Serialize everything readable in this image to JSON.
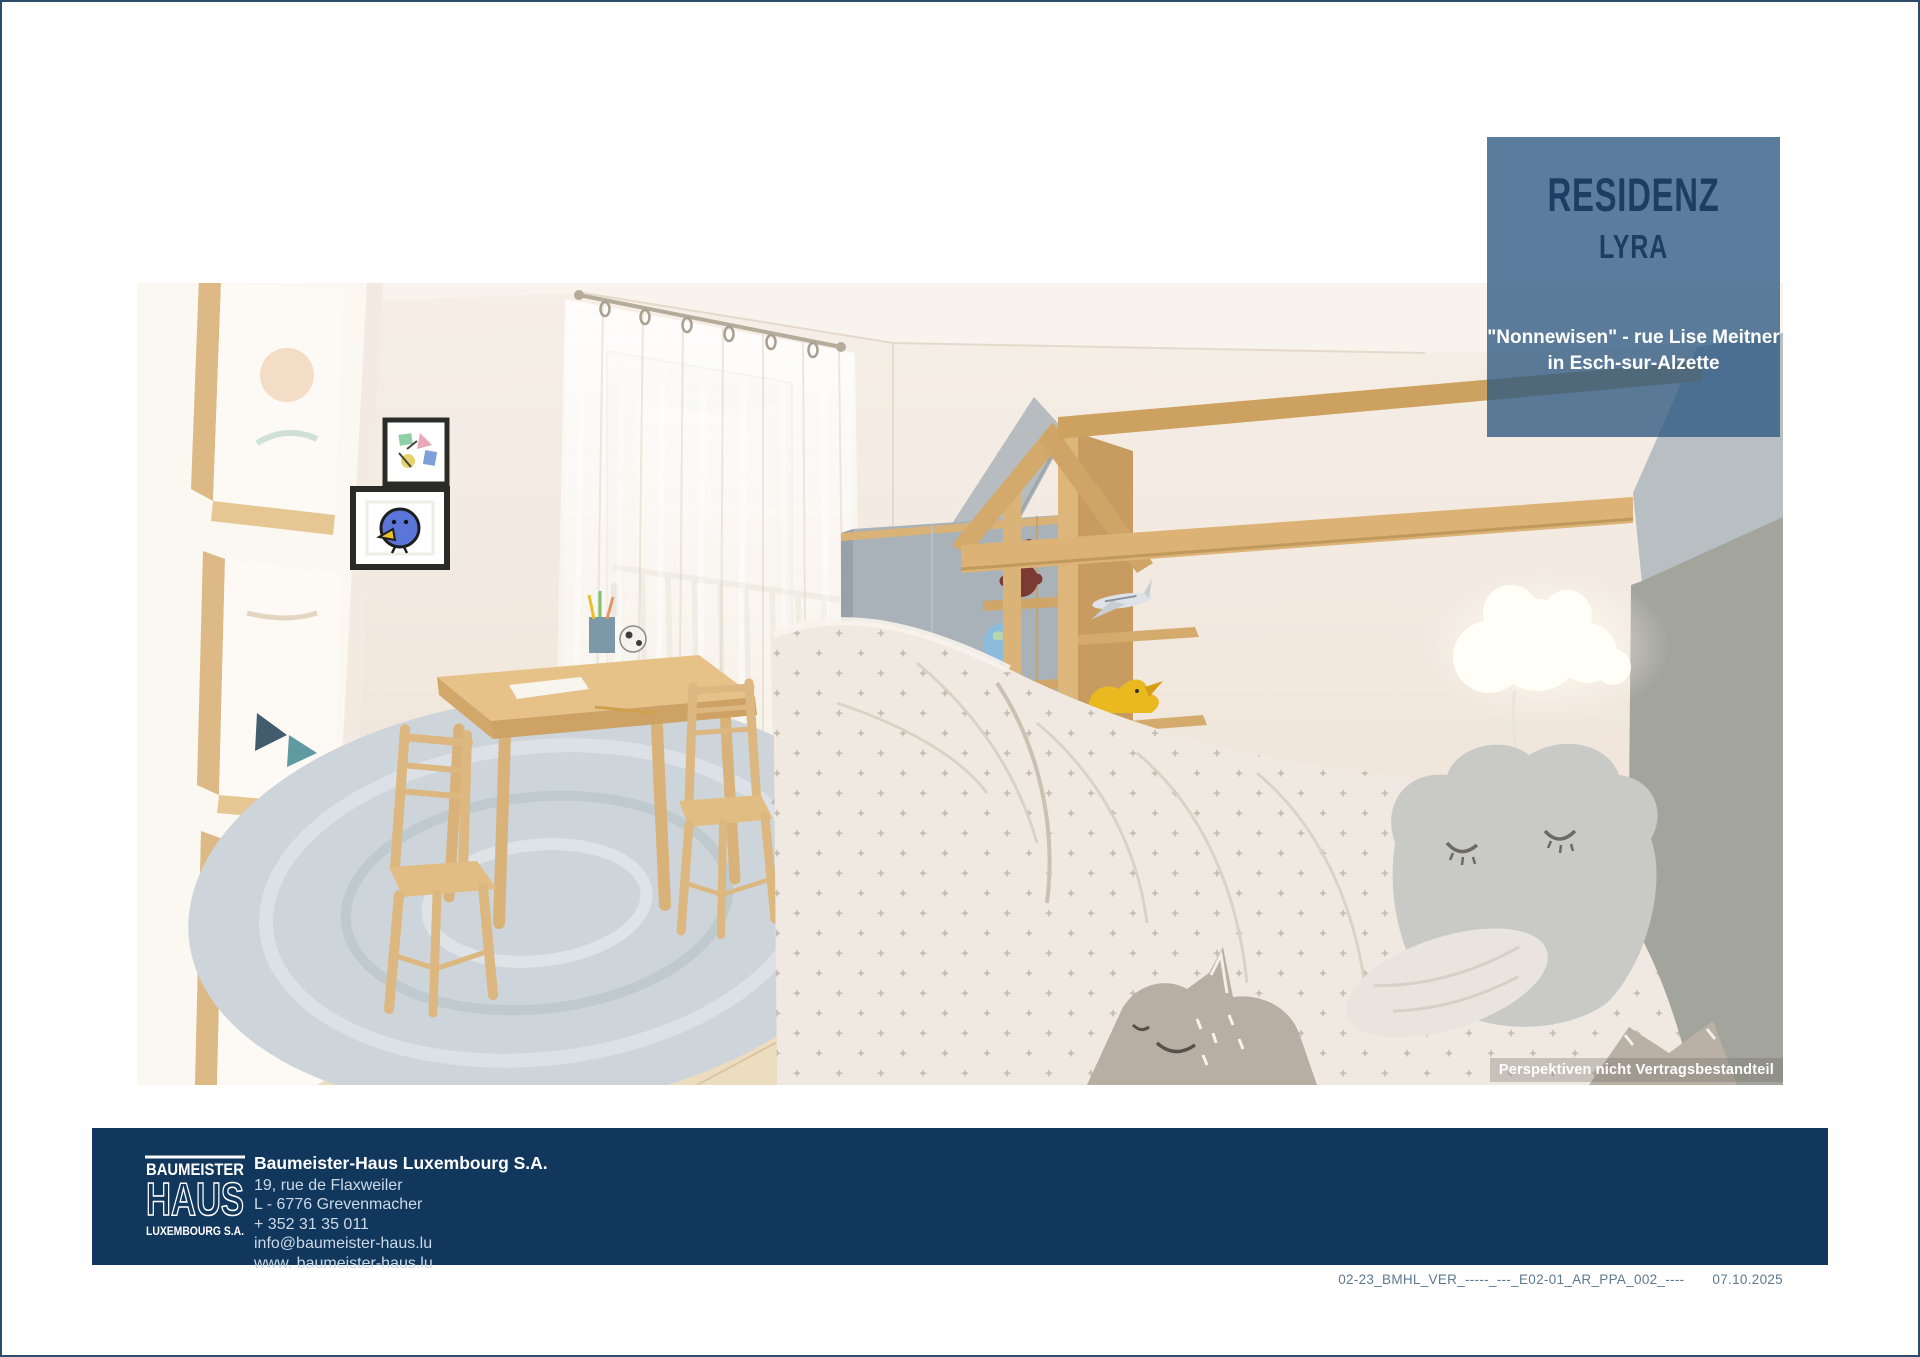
{
  "badge": {
    "title": "RESIDENZ",
    "subtitle": "LYRA",
    "location_line1": "\"Nonnewisen\" - rue Lise Meitner",
    "location_line2": "in Esch-sur-Alzette"
  },
  "image": {
    "subject": "kids-bedroom-3d-rendering",
    "disclaimer": "Perspektiven nicht Vertragsbestandteil"
  },
  "footer": {
    "logo": {
      "line1": "BAUMEISTER",
      "line2": "HAUS",
      "line3": "LUXEMBOURG S.A."
    },
    "company": {
      "name": "Baumeister-Haus Luxembourg S.A.",
      "address_line1": "19, rue de Flaxweiler",
      "address_line2": "L - 6776 Grevenmacher",
      "phone": "+ 352 31 35 011",
      "email": "info@baumeister-haus.lu",
      "website": "www. baumeister-haus.lu"
    }
  },
  "document_meta": {
    "reference": "02-23_BMHL_VER_-----_---_E02-01_AR_PPA_002_----",
    "date": "07.10.2025"
  },
  "colors": {
    "footer_navy": "#11375d",
    "badge_blue": "#5b7d9d",
    "badge_text_navy": "#1c3e63",
    "page_border": "#2e4d6b",
    "wood": "#d9b378",
    "wall_cream": "#f3eae1"
  }
}
